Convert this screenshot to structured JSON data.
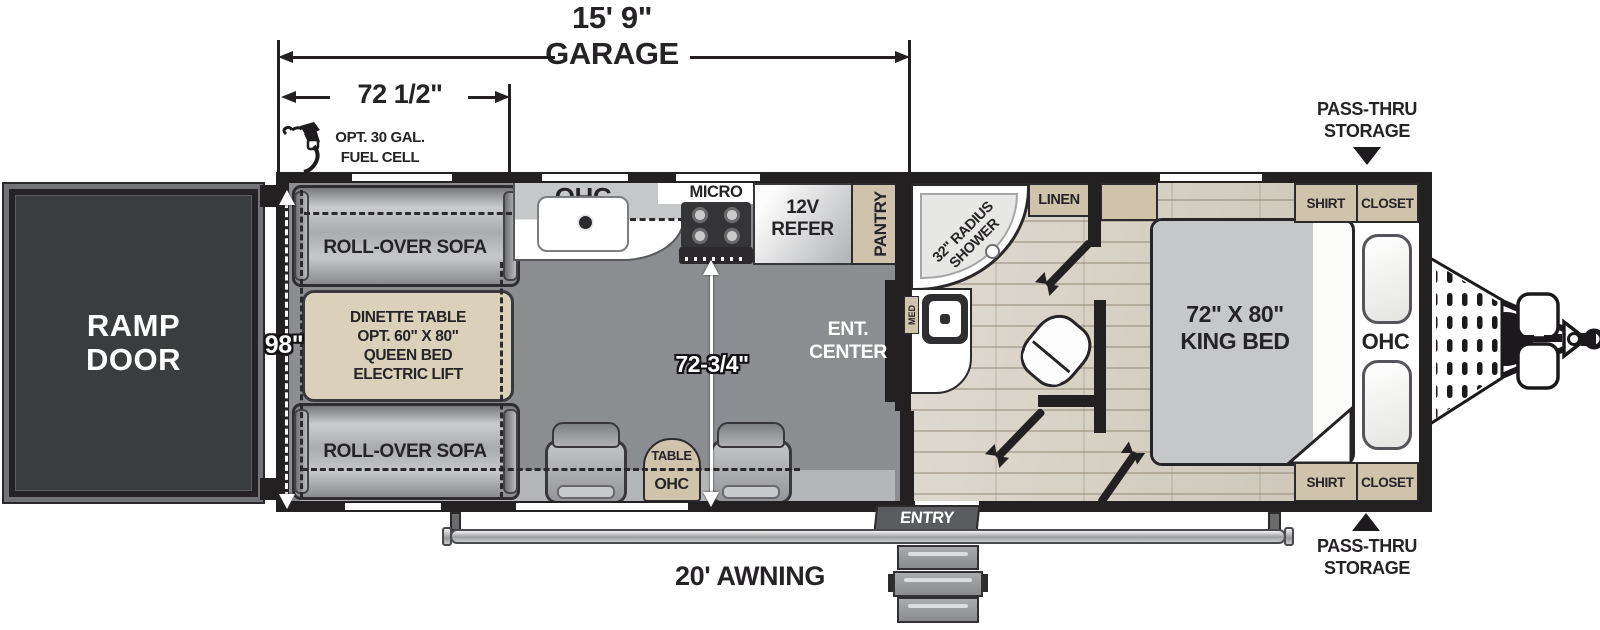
{
  "dimensions": {
    "garage_length": "15' 9\"",
    "garage_word": "GARAGE",
    "sofa_width": "72 1/2\"",
    "garage_width": "98\"",
    "living_width": "72-3/4\""
  },
  "exterior": {
    "fuel_line1": "OPT. 30 GAL.",
    "fuel_line2": "FUEL CELL",
    "ramp_line1": "RAMP",
    "ramp_line2": "DOOR",
    "awning": "20' AWNING",
    "entry": "ENTRY",
    "pass_thru_top_line1": "PASS-THRU",
    "pass_thru_top_line2": "STORAGE",
    "pass_thru_bottom_line1": "PASS-THRU",
    "pass_thru_bottom_line2": "STORAGE"
  },
  "garage": {
    "sofa_top": "ROLL-OVER SOFA",
    "sofa_bottom": "ROLL-OVER SOFA",
    "dinette_line1": "DINETTE TABLE",
    "dinette_line2": "OPT. 60\" X 80\"",
    "dinette_line3": "QUEEN BED",
    "dinette_line4": "ELECTRIC LIFT"
  },
  "kitchen": {
    "ohc": "OHC",
    "micro": "MICRO",
    "refer_line1": "12V",
    "refer_line2": "REFER",
    "pantry": "PANTRY"
  },
  "living": {
    "ent_line1": "ENT.",
    "ent_line2": "CENTER",
    "table": "TABLE",
    "table_ohc": "OHC"
  },
  "bath": {
    "shower_line1": "32\" RADIUS",
    "shower_line2": "SHOWER",
    "med": "MED",
    "linen": "LINEN"
  },
  "bedroom": {
    "bed_line1": "72\" X 80\"",
    "bed_line2": "KING BED",
    "ohc": "OHC",
    "shirt_top_left": "SHIRT",
    "shirt_top_right": "CLOSET",
    "shirt_bottom_left": "SHIRT",
    "shirt_bottom_right": "CLOSET"
  },
  "colors": {
    "wall": "#232021",
    "floor_gray": "#8b8d90",
    "wood": "#d5cec1",
    "tan": "#cfc4ab"
  }
}
